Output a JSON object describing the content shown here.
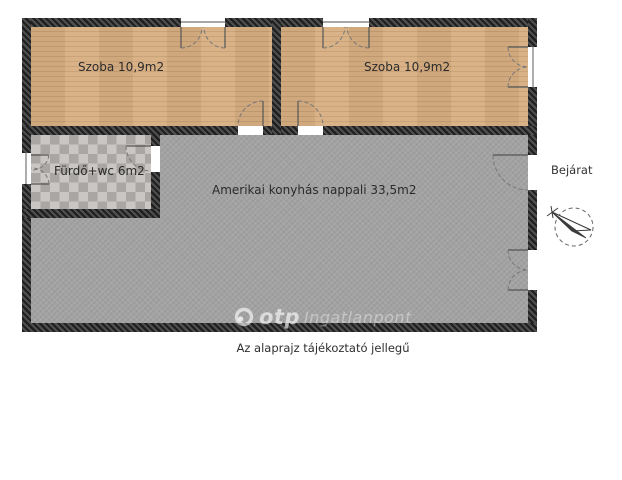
{
  "plan": {
    "rooms": [
      {
        "id": "szoba-1",
        "label": "Szoba 10,9m2",
        "floor": "wood"
      },
      {
        "id": "szoba-2",
        "label": "Szoba 10,9m2",
        "floor": "wood"
      },
      {
        "id": "furdo-wc",
        "label": "Fürdő+wc 6m2",
        "floor": "tile"
      },
      {
        "id": "nappali",
        "label": "Amerikai konyhás nappali 33,5m2",
        "floor": "gray"
      }
    ],
    "entrance_label": "Bejárat"
  },
  "watermark": {
    "brand": "otp",
    "suffix": "Ingatlanpont"
  },
  "caption": "Az alaprajz tájékoztató jellegű",
  "icons": {
    "compass": "compass-needle-in-dashed-circle",
    "otp_logo": "ring-with-dot",
    "window": "double-casement-arcs",
    "door": "quarter-circle-swing-arc"
  },
  "colors": {
    "wood": "#d7ae82",
    "wood_line": "#c79e72",
    "tile_light": "#c9c6c3",
    "tile_dark": "#a9a6a3",
    "floor": "#a3a3a3",
    "wall": "#1f1f1f",
    "wall_light": "#4f4f4f",
    "text": "#2b2b2b"
  }
}
